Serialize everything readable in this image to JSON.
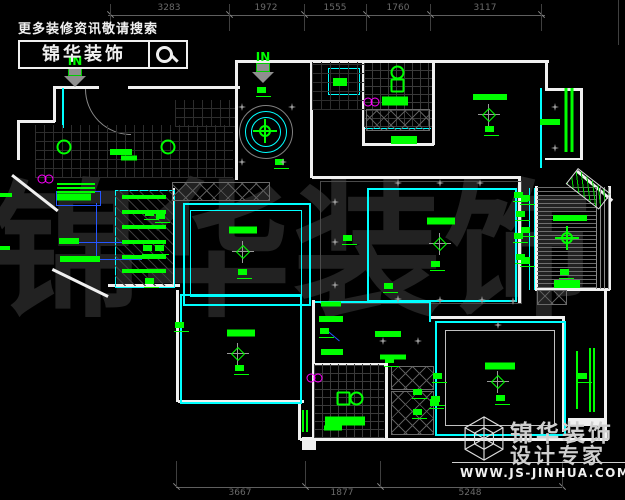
{
  "promo": {
    "headline": "更多装修资讯敬请搜索",
    "brand": "锦华装饰"
  },
  "footer": {
    "name": "锦华装饰",
    "tagline": "设计专家",
    "website": "WWW.JS-JINHUA.COM"
  },
  "watermark": {
    "text": "锦华装饰"
  },
  "entry": {
    "in": "IN"
  },
  "colors": {
    "annotation_green": "#00ff00",
    "ceiling_cyan": "#00ffff",
    "wall_white": "#f0f0f0",
    "accent_magenta": "#ff00ff",
    "leader_blue": "#2456ff",
    "dim_gray": "#5f5f5f",
    "watermark_gray": "#222222"
  },
  "dimensions": {
    "top": {
      "y": 15,
      "x_start": 108,
      "x_end": 545,
      "ticks": [
        110,
        229,
        304,
        366,
        430,
        541
      ],
      "labels": [
        {
          "text": "3283",
          "x": 169
        },
        {
          "text": "1972",
          "x": 266
        },
        {
          "text": "1555",
          "x": 335
        },
        {
          "text": "1760",
          "x": 398
        },
        {
          "text": "3117",
          "x": 485
        }
      ]
    },
    "bottom": {
      "y": 487,
      "x_start": 176,
      "x_end": 562,
      "ticks": [
        176,
        305,
        380,
        562
      ],
      "labels": [
        {
          "text": "3667",
          "x": 240
        },
        {
          "text": "1877",
          "x": 342
        },
        {
          "text": "5248",
          "x": 470
        }
      ]
    }
  },
  "plan_geometry": {
    "walls": [
      [
        53,
        86,
        46,
        3
      ],
      [
        128,
        86,
        112,
        3
      ],
      [
        237,
        60,
        312,
        3
      ],
      [
        545,
        88,
        38,
        3
      ],
      [
        108,
        284,
        72,
        3
      ],
      [
        17,
        120,
        38,
        3
      ],
      [
        312,
        176,
        208,
        3
      ],
      [
        362,
        143,
        72,
        3
      ],
      [
        178,
        400,
        126,
        3
      ],
      [
        300,
        438,
        308,
        3
      ],
      [
        430,
        316,
        135,
        3
      ],
      [
        312,
        363,
        76,
        3
      ],
      [
        535,
        288,
        75,
        3
      ],
      [
        545,
        158,
        38,
        2
      ],
      [
        568,
        418,
        36,
        8
      ],
      [
        302,
        437,
        14,
        13
      ],
      [
        53,
        86,
        3,
        36
      ],
      [
        17,
        120,
        3,
        40
      ],
      [
        235,
        60,
        3,
        120
      ],
      [
        310,
        62,
        3,
        116
      ],
      [
        362,
        62,
        3,
        83
      ],
      [
        432,
        62,
        3,
        83
      ],
      [
        545,
        60,
        3,
        30
      ],
      [
        580,
        88,
        3,
        72
      ],
      [
        608,
        186,
        3,
        104
      ],
      [
        604,
        290,
        3,
        150
      ],
      [
        176,
        290,
        3,
        112
      ],
      [
        298,
        400,
        3,
        40
      ],
      [
        312,
        300,
        3,
        140
      ],
      [
        385,
        363,
        3,
        77
      ],
      [
        518,
        176,
        3,
        128
      ],
      [
        535,
        186,
        3,
        104
      ],
      [
        562,
        318,
        3,
        114
      ],
      [
        173,
        188,
        2,
        98
      ]
    ],
    "diag_walls": [
      [
        13,
        174,
        58,
        38
      ],
      [
        53,
        268,
        62,
        26
      ],
      [
        578,
        170,
        46,
        40
      ]
    ],
    "cyan_rects": [
      [
        328,
        68,
        30,
        25,
        1
      ],
      [
        115,
        190,
        58,
        96,
        1
      ],
      [
        183,
        203,
        124,
        99,
        2
      ],
      [
        190,
        210,
        110,
        85,
        1
      ],
      [
        367,
        188,
        146,
        110,
        2
      ],
      [
        180,
        294,
        118,
        106,
        2
      ],
      [
        435,
        321,
        127,
        111,
        2
      ],
      [
        445,
        330,
        108,
        94,
        1,
        "#c0c0c0"
      ],
      [
        320,
        181,
        200,
        121,
        1,
        "#4a4a4a"
      ]
    ],
    "cyan_lines": [
      [
        57,
        177,
        115,
        1
      ],
      [
        365,
        128,
        66,
        1
      ],
      [
        315,
        301,
        116,
        2
      ],
      [
        429,
        301,
        2,
        21
      ],
      [
        529,
        188,
        1,
        102
      ],
      [
        534,
        188,
        1,
        102
      ],
      [
        62,
        88,
        2,
        40
      ],
      [
        540,
        88,
        2,
        80
      ]
    ],
    "hatches": [
      [
        "grid9",
        35,
        125,
        198,
        53
      ],
      [
        "grid9",
        175,
        100,
        60,
        27
      ],
      [
        "grid9",
        312,
        62,
        52,
        48
      ],
      [
        "grid8",
        364,
        63,
        68,
        64
      ],
      [
        "grid8",
        314,
        364,
        70,
        74
      ],
      [
        "diag",
        115,
        190,
        58,
        96
      ],
      [
        "xh",
        366,
        109,
        62,
        20
      ],
      [
        "xh",
        172,
        182,
        96,
        17
      ],
      [
        "xh",
        537,
        290,
        28,
        13
      ],
      [
        "xh",
        391,
        366,
        41,
        22
      ],
      [
        "xh",
        391,
        391,
        41,
        42
      ],
      [
        "hs",
        537,
        187,
        60,
        102
      ],
      [
        "vs",
        596,
        187,
        13,
        102
      ],
      [
        "gs",
        578,
        168,
        40,
        18,
        38
      ]
    ],
    "blue_rects": [
      [
        56,
        191,
        43,
        13
      ]
    ],
    "blue_lines": [
      [
        77,
        242,
        58,
        1,
        0
      ],
      [
        98,
        259,
        44,
        1,
        0
      ],
      [
        96,
        203,
        1,
        56,
        0
      ],
      [
        326,
        329,
        18,
        1,
        40
      ]
    ]
  },
  "plan_marks": [
    [
      "bar",
      121,
      152,
      22,
      6
    ],
    [
      "bar",
      129,
      158,
      16,
      5
    ],
    [
      "bar",
      74,
      197,
      34,
      7
    ],
    [
      "bar",
      69,
      241,
      20,
      6
    ],
    [
      "bar",
      80,
      259,
      40,
      6
    ],
    [
      "bar",
      6,
      195,
      12,
      4
    ],
    [
      "bar",
      5,
      248,
      10,
      4
    ],
    [
      "bar",
      76,
      184,
      38,
      2
    ],
    [
      "bar",
      76,
      188,
      38,
      2
    ],
    [
      "bar",
      76,
      192,
      38,
      2
    ],
    [
      "bar",
      144,
      197,
      44,
      4
    ],
    [
      "bar",
      144,
      212,
      44,
      4
    ],
    [
      "bar",
      144,
      227,
      44,
      4
    ],
    [
      "bar",
      144,
      242,
      44,
      4
    ],
    [
      "bar",
      144,
      257,
      44,
      4
    ],
    [
      "bar",
      144,
      271,
      44,
      4
    ],
    [
      "bar",
      340,
      82,
      14,
      8
    ],
    [
      "bar",
      395,
      101,
      26,
      9
    ],
    [
      "bar",
      404,
      140,
      26,
      8
    ],
    [
      "bar",
      490,
      97,
      34,
      6
    ],
    [
      "bar",
      550,
      122,
      20,
      6
    ],
    [
      "bar",
      570,
      218,
      34,
      6
    ],
    [
      "bar",
      567,
      284,
      26,
      8
    ],
    [
      "bar",
      441,
      221,
      28,
      7
    ],
    [
      "bar",
      243,
      230,
      28,
      7
    ],
    [
      "bar",
      241,
      333,
      28,
      7
    ],
    [
      "bar",
      500,
      366,
      30,
      7
    ],
    [
      "bar",
      331,
      304,
      20,
      5
    ],
    [
      "bar",
      331,
      319,
      24,
      6
    ],
    [
      "bar",
      332,
      352,
      22,
      6
    ],
    [
      "bar",
      388,
      334,
      26,
      6
    ],
    [
      "bar",
      393,
      357,
      26,
      5
    ],
    [
      "bar",
      345,
      421,
      40,
      9
    ],
    [
      "bar",
      333,
      428,
      18,
      5
    ],
    [
      "vbar",
      590,
      380,
      2,
      64
    ],
    [
      "vbar",
      594,
      380,
      2,
      64
    ],
    [
      "vbar",
      577,
      380,
      2,
      58
    ],
    [
      "vbar",
      566,
      120,
      3,
      64
    ],
    [
      "vbar",
      572,
      120,
      3,
      64
    ],
    [
      "vbar",
      303,
      421,
      2,
      22
    ],
    [
      "vbar",
      307,
      421,
      2,
      22
    ],
    [
      "note",
      264,
      92
    ],
    [
      "note",
      282,
      164
    ],
    [
      "note",
      152,
      215
    ],
    [
      "note",
      150,
      250
    ],
    [
      "note",
      152,
      283
    ],
    [
      "note",
      163,
      218
    ],
    [
      "note",
      162,
      250
    ],
    [
      "note",
      492,
      131
    ],
    [
      "note",
      528,
      200
    ],
    [
      "note",
      528,
      232
    ],
    [
      "note",
      528,
      262
    ],
    [
      "note",
      567,
      274
    ],
    [
      "note",
      438,
      266
    ],
    [
      "note",
      391,
      288
    ],
    [
      "note",
      350,
      240
    ],
    [
      "note",
      521,
      197
    ],
    [
      "note",
      523,
      216
    ],
    [
      "note",
      521,
      238
    ],
    [
      "note",
      523,
      259
    ],
    [
      "note",
      245,
      274
    ],
    [
      "note",
      242,
      370
    ],
    [
      "note",
      182,
      327
    ],
    [
      "note",
      327,
      333
    ],
    [
      "note",
      392,
      362
    ],
    [
      "note",
      420,
      394
    ],
    [
      "note",
      420,
      414
    ],
    [
      "note",
      437,
      404
    ],
    [
      "note",
      440,
      378
    ],
    [
      "note",
      438,
      401
    ],
    [
      "note",
      503,
      400
    ],
    [
      "note",
      585,
      378
    ],
    [
      "diamond",
      489,
      115
    ],
    [
      "diamond",
      440,
      244
    ],
    [
      "diamond",
      243,
      252
    ],
    [
      "diamond",
      238,
      354
    ],
    [
      "diamond",
      498,
      382
    ],
    [
      "downlight",
      64,
      147
    ],
    [
      "downlight",
      168,
      147
    ],
    [
      "fan",
      265,
      131
    ],
    [
      "fan",
      567,
      238
    ],
    [
      "toiletv",
      398,
      79
    ],
    [
      "toileth",
      350,
      399
    ],
    [
      "magenta",
      46,
      179
    ],
    [
      "magenta",
      372,
      102
    ],
    [
      "magenta",
      315,
      378
    ],
    [
      "star",
      242,
      107
    ],
    [
      "star",
      292,
      107
    ],
    [
      "star",
      242,
      162
    ],
    [
      "star",
      283,
      162
    ],
    [
      "star",
      335,
      202
    ],
    [
      "star",
      335,
      242
    ],
    [
      "star",
      335,
      285
    ],
    [
      "star",
      398,
      183
    ],
    [
      "star",
      440,
      183
    ],
    [
      "star",
      480,
      183
    ],
    [
      "star",
      398,
      299
    ],
    [
      "star",
      440,
      300
    ],
    [
      "star",
      482,
      300
    ],
    [
      "star",
      513,
      301
    ],
    [
      "star",
      555,
      107
    ],
    [
      "star",
      555,
      148
    ],
    [
      "star",
      383,
      341
    ],
    [
      "star",
      418,
      341
    ],
    [
      "star",
      498,
      325
    ]
  ]
}
